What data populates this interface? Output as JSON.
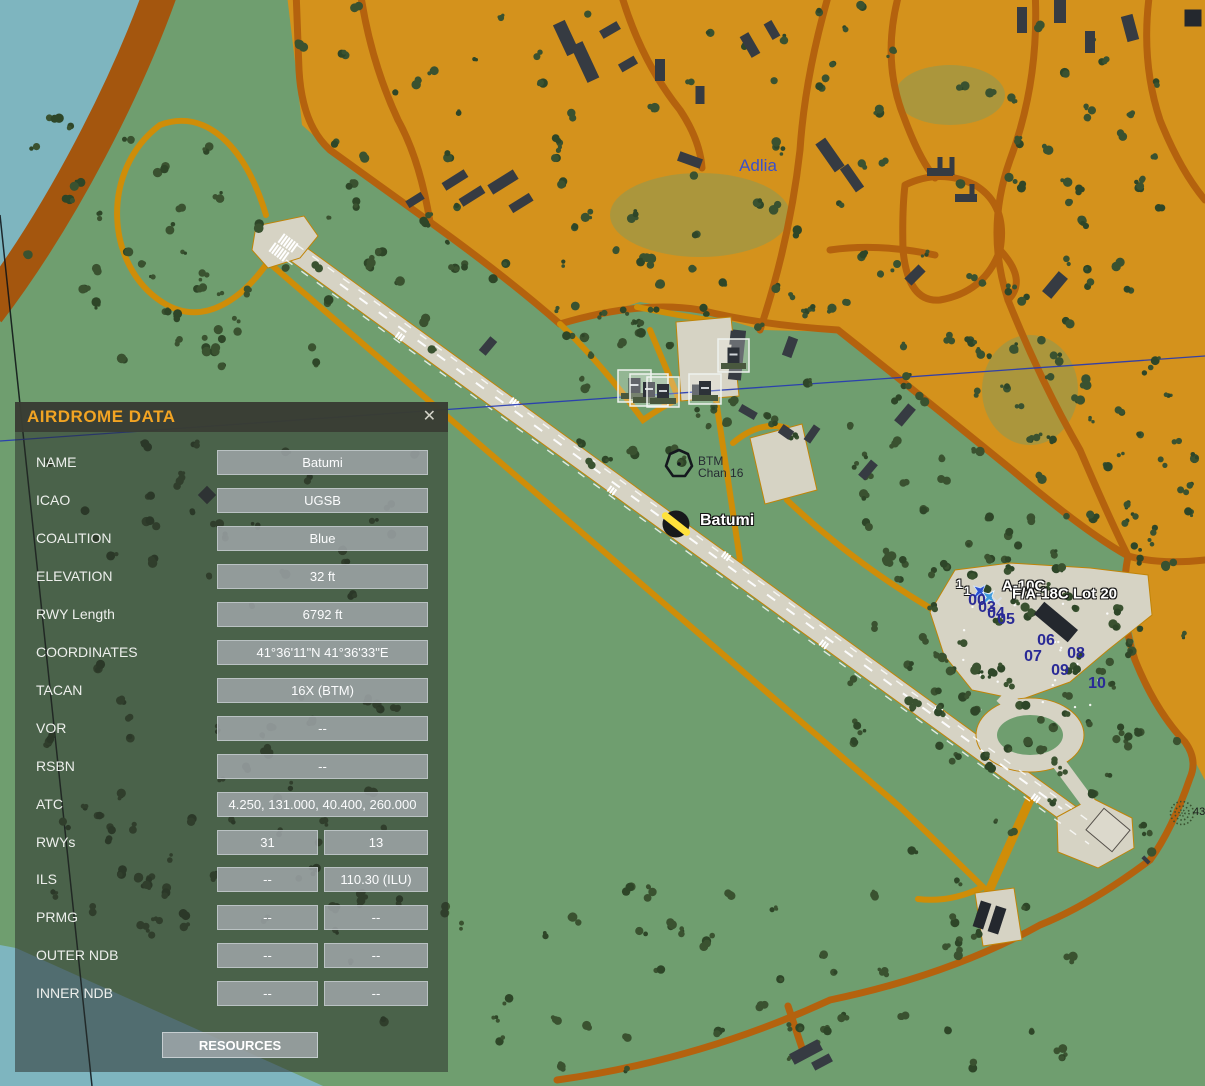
{
  "window": {
    "title": "AIRDROME DATA",
    "close_glyph": "✕"
  },
  "panel": {
    "rows": [
      {
        "label": "NAME",
        "values": [
          "Batumi"
        ]
      },
      {
        "label": "ICAO",
        "values": [
          "UGSB"
        ]
      },
      {
        "label": "COALITION",
        "values": [
          "Blue"
        ]
      },
      {
        "label": "ELEVATION",
        "values": [
          "32 ft"
        ]
      },
      {
        "label": "RWY Length",
        "values": [
          "6792 ft"
        ]
      },
      {
        "label": "COORDINATES",
        "values": [
          "41°36'11\"N 41°36'33\"E"
        ]
      },
      {
        "label": "TACAN",
        "values": [
          "16X (BTM)"
        ]
      },
      {
        "label": "VOR",
        "values": [
          "--"
        ]
      },
      {
        "label": "RSBN",
        "values": [
          "--"
        ]
      },
      {
        "label": "ATC",
        "values": [
          "4.250, 131.000, 40.400, 260.000"
        ]
      },
      {
        "label": "RWYs",
        "values": [
          "31",
          "13"
        ]
      },
      {
        "label": "ILS",
        "values": [
          "--",
          "110.30 (ILU)"
        ]
      },
      {
        "label": "PRMG",
        "values": [
          "--",
          "--"
        ]
      },
      {
        "label": "OUTER NDB",
        "values": [
          "--",
          "--"
        ]
      },
      {
        "label": "INNER NDB",
        "values": [
          "--",
          "--"
        ]
      }
    ],
    "button_label": "RESOURCES"
  },
  "map": {
    "town_label": {
      "text": "Adlia",
      "x": 758,
      "y": 166
    },
    "tacan_beacon": {
      "line1": "BTM",
      "line2": "Chan 16",
      "x": 698,
      "y": 455
    },
    "airport_label": {
      "text": "Batumi",
      "x": 700,
      "y": 521
    },
    "unit_labels": [
      {
        "text": "A-10C",
        "x": 1002,
        "y": 586
      },
      {
        "text": "F/A-18C Lot 20",
        "x": 1012,
        "y": 594
      }
    ],
    "group_counts": [
      {
        "text": "1",
        "x": 956,
        "y": 584
      },
      {
        "text": "1",
        "x": 964,
        "y": 591
      }
    ],
    "parking_spots": [
      {
        "text": "00",
        "x": 977,
        "y": 601
      },
      {
        "text": "03",
        "x": 987,
        "y": 608
      },
      {
        "text": "04",
        "x": 996,
        "y": 614
      },
      {
        "text": "05",
        "x": 1006,
        "y": 620
      },
      {
        "text": "06",
        "x": 1046,
        "y": 641
      },
      {
        "text": "07",
        "x": 1033,
        "y": 657
      },
      {
        "text": "08",
        "x": 1076,
        "y": 654
      },
      {
        "text": "09",
        "x": 1060,
        "y": 671
      },
      {
        "text": "10",
        "x": 1097,
        "y": 684
      }
    ],
    "grove_number": {
      "text": "43",
      "x": 1193,
      "y": 812
    },
    "colors": {
      "sea": "#7eb5bf",
      "land": "#6f9e6f",
      "city": "#d4921c",
      "road_dark": "#b4620e",
      "road_bright": "#cf8d08",
      "river_band": "#a4560e",
      "pavement": "#d6d3c4",
      "tree": "#3a5230",
      "tree_dark": "#2e4628",
      "building": "#363b42",
      "accent_orange": "#f2a423",
      "parking_blue": "#2a2a96"
    }
  }
}
